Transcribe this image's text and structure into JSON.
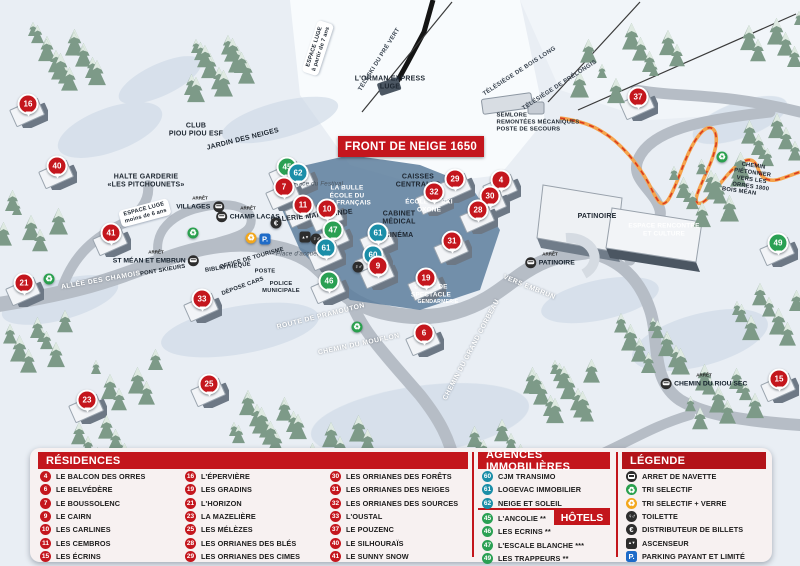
{
  "colors": {
    "red": "#c4161d",
    "teal": "#1b8ea8",
    "green": "#2aa053",
    "panel_red": "#c3161c"
  },
  "map": {
    "banner": "FRONT DE NEIGE 1650",
    "bus_stop_prefix": "ARRÊT",
    "markers": [
      {
        "n": "16",
        "c": "red",
        "x": 28,
        "y": 104
      },
      {
        "n": "40",
        "c": "red",
        "x": 57,
        "y": 166
      },
      {
        "n": "41",
        "c": "red",
        "x": 111,
        "y": 233
      },
      {
        "n": "21",
        "c": "red",
        "x": 24,
        "y": 283
      },
      {
        "n": "33",
        "c": "red",
        "x": 202,
        "y": 299
      },
      {
        "n": "23",
        "c": "red",
        "x": 87,
        "y": 400
      },
      {
        "n": "25",
        "c": "red",
        "x": 209,
        "y": 384
      },
      {
        "n": "45",
        "c": "green",
        "x": 287,
        "y": 167
      },
      {
        "n": "62",
        "c": "teal",
        "x": 298,
        "y": 173
      },
      {
        "n": "7",
        "c": "red",
        "x": 284,
        "y": 187
      },
      {
        "n": "11",
        "c": "red",
        "x": 303,
        "y": 205
      },
      {
        "n": "10",
        "c": "red",
        "x": 327,
        "y": 209
      },
      {
        "n": "47",
        "c": "green",
        "x": 333,
        "y": 230
      },
      {
        "n": "61",
        "c": "teal",
        "x": 326,
        "y": 248
      },
      {
        "n": "61",
        "c": "teal",
        "x": 378,
        "y": 233
      },
      {
        "n": "60",
        "c": "teal",
        "x": 373,
        "y": 255
      },
      {
        "n": "9",
        "c": "red",
        "x": 378,
        "y": 266
      },
      {
        "n": "46",
        "c": "green",
        "x": 329,
        "y": 281
      },
      {
        "n": "19",
        "c": "red",
        "x": 426,
        "y": 278
      },
      {
        "n": "6",
        "c": "red",
        "x": 424,
        "y": 333
      },
      {
        "n": "32",
        "c": "red",
        "x": 434,
        "y": 192
      },
      {
        "n": "29",
        "c": "red",
        "x": 455,
        "y": 179
      },
      {
        "n": "4",
        "c": "red",
        "x": 501,
        "y": 180
      },
      {
        "n": "30",
        "c": "red",
        "x": 490,
        "y": 196
      },
      {
        "n": "28",
        "c": "red",
        "x": 478,
        "y": 210
      },
      {
        "n": "31",
        "c": "red",
        "x": 452,
        "y": 241
      },
      {
        "n": "37",
        "c": "red",
        "x": 638,
        "y": 97
      },
      {
        "n": "49",
        "c": "green",
        "x": 778,
        "y": 243
      },
      {
        "n": "15",
        "c": "red",
        "x": 779,
        "y": 379
      }
    ],
    "labels": [
      {
        "text": "L'ORMAN EXPRESS\nLUGE",
        "x": 390,
        "y": 84,
        "r": 0,
        "cls": "map-bold"
      },
      {
        "text": "TÉLÉSKI DU PRÉ VERT",
        "x": 380,
        "y": 60,
        "r": -58,
        "cls": "map-small"
      },
      {
        "text": "TÉLÉSIÈGE DE BOIS LONG",
        "x": 520,
        "y": 72,
        "r": -33,
        "cls": "map-small"
      },
      {
        "text": "TÉLÉSIÈGE DE PRÉLONGIS",
        "x": 560,
        "y": 86,
        "r": -33,
        "cls": "map-small"
      },
      {
        "text": "SEMLORE\nREMONTÉES MÉCANIQUES\nPOSTE DE SECOURS",
        "x": 538,
        "y": 123,
        "r": 0,
        "cls": "map-bold-left"
      },
      {
        "text": "ESPACE LUGE\nà partir de 7 ans",
        "x": 318,
        "y": 48,
        "r": -72,
        "cls": "map-pill"
      },
      {
        "text": "ESPACE LUGE\nmoins de 6 ans",
        "x": 145,
        "y": 213,
        "r": -15,
        "cls": "map-pill"
      },
      {
        "text": "CLUB\nPIOU PIOU ESF",
        "x": 196,
        "y": 131,
        "r": 0,
        "cls": "map-bold"
      },
      {
        "text": "JARDIN DES NEIGES",
        "x": 243,
        "y": 140,
        "r": -14,
        "cls": "map-bold"
      },
      {
        "text": "HALTE GARDERIE\n«LES PITCHOUNETS»",
        "x": 146,
        "y": 182,
        "r": 0,
        "cls": "map-bold"
      },
      {
        "text": "GALERIE MARCHANDE",
        "x": 312,
        "y": 217,
        "r": -6,
        "cls": "map-bold"
      },
      {
        "text": "LA BULLE\nÉCOLE DU\nSKI FRANÇAIS",
        "x": 347,
        "y": 196,
        "r": 0,
        "cls": "map-white"
      },
      {
        "text": "Place du Festival",
        "x": 318,
        "y": 184,
        "r": 0,
        "cls": "map-italic"
      },
      {
        "text": "Place d'accueil",
        "x": 298,
        "y": 254,
        "r": 0,
        "cls": "map-italic"
      },
      {
        "text": "OFFICE DE TOURISME",
        "x": 252,
        "y": 259,
        "r": -16,
        "cls": "map-tiny"
      },
      {
        "text": "BIBLIOTHÈQUE",
        "x": 228,
        "y": 268,
        "r": -8,
        "cls": "map-tiny"
      },
      {
        "text": "POSTE",
        "x": 265,
        "y": 272,
        "r": 0,
        "cls": "map-tiny"
      },
      {
        "text": "DÉPOSE CARS",
        "x": 243,
        "y": 287,
        "r": -20,
        "cls": "map-tiny"
      },
      {
        "text": "POLICE\nMUNICIPALE",
        "x": 281,
        "y": 288,
        "r": 0,
        "cls": "map-tiny"
      },
      {
        "text": "CAISSES\nCENTRALES",
        "x": 418,
        "y": 182,
        "r": 0,
        "cls": "map-bold"
      },
      {
        "text": "CABINET\nMÉDICAL",
        "x": 399,
        "y": 219,
        "r": 0,
        "cls": "map-bold"
      },
      {
        "text": "CINÉMA",
        "x": 399,
        "y": 236,
        "r": 0,
        "cls": "map-bold"
      },
      {
        "text": "LAVERIE",
        "x": 466,
        "y": 152,
        "r": 0,
        "cls": "map-bold"
      },
      {
        "text": "ÉCOLE DE SKI\nOXONE",
        "x": 429,
        "y": 206,
        "r": 0,
        "cls": "map-white"
      },
      {
        "text": "SALLE DE\nSPECTACLE",
        "x": 431,
        "y": 291,
        "r": 0,
        "cls": "map-white"
      },
      {
        "text": "GENDARMERIE",
        "x": 438,
        "y": 302,
        "r": 0,
        "cls": "map-white-tiny"
      },
      {
        "text": "PATINOIRE",
        "x": 597,
        "y": 217,
        "r": 0,
        "cls": "map-bold"
      },
      {
        "text": "VERS EMBRUN",
        "x": 529,
        "y": 288,
        "r": 22,
        "cls": "map-road"
      },
      {
        "text": "ESPACE RENCONTRE\nET CULTURE",
        "x": 664,
        "y": 230,
        "r": 0,
        "cls": "map-white"
      },
      {
        "text": "CHEMIN PIÉTONNIER\nVERS LES ORRES 1800",
        "x": 752,
        "y": 177,
        "r": 8,
        "cls": "map-tiny"
      },
      {
        "text": "BOIS MÉAN",
        "x": 739,
        "y": 192,
        "r": 8,
        "cls": "map-tiny"
      },
      {
        "text": "ALLÉE DES CHAMOIS",
        "x": 101,
        "y": 281,
        "r": -10,
        "cls": "map-road"
      },
      {
        "text": "PONT SKIEURS",
        "x": 163,
        "y": 271,
        "r": -10,
        "cls": "map-tiny"
      },
      {
        "text": "ROUTE DE PRAMOUTON",
        "x": 321,
        "y": 317,
        "r": -14,
        "cls": "map-road"
      },
      {
        "text": "CHEMIN DU MOUFLON",
        "x": 359,
        "y": 345,
        "r": -12,
        "cls": "map-road"
      },
      {
        "text": "CHEMIN DU GRAND CORBEAU",
        "x": 472,
        "y": 350,
        "r": -62,
        "cls": "map-road"
      }
    ],
    "bus_stops": [
      {
        "label": "VILLAGES",
        "x": 200,
        "y": 204,
        "side": "right"
      },
      {
        "label": "CHAMP LACAS",
        "x": 248,
        "y": 214,
        "side": "left"
      },
      {
        "label": "ST MÉAN ET EMBRUN",
        "x": 156,
        "y": 258,
        "side": "right"
      },
      {
        "label": "PATINOIRE",
        "x": 550,
        "y": 260,
        "side": "left"
      },
      {
        "label": "CHEMIN DU RIOU SEC",
        "x": 704,
        "y": 381,
        "side": "left"
      }
    ],
    "amenities": [
      {
        "type": "recycle-green",
        "x": 193,
        "y": 233
      },
      {
        "type": "recycle-green",
        "x": 49,
        "y": 279
      },
      {
        "type": "recycle-green",
        "x": 357,
        "y": 327
      },
      {
        "type": "recycle-green",
        "x": 722,
        "y": 157
      },
      {
        "type": "recycle-yellow",
        "x": 251,
        "y": 238
      },
      {
        "type": "parking",
        "x": 265,
        "y": 239
      },
      {
        "type": "euro",
        "x": 276,
        "y": 223
      },
      {
        "type": "elevator",
        "x": 305,
        "y": 237
      },
      {
        "type": "toilet",
        "x": 316,
        "y": 239
      },
      {
        "type": "toilet",
        "x": 358,
        "y": 267
      }
    ]
  },
  "panel": {
    "residences": {
      "title": "RÉSIDENCES",
      "columns": [
        [
          {
            "n": "4",
            "label": "LE BALCON DES ORRES"
          },
          {
            "n": "6",
            "label": "LE BELVÉDÈRE"
          },
          {
            "n": "7",
            "label": "LE BOUSSOLENC"
          },
          {
            "n": "9",
            "label": "LE CAIRN"
          },
          {
            "n": "10",
            "label": "LES CARLINES"
          },
          {
            "n": "11",
            "label": "LES CEMBROS"
          },
          {
            "n": "15",
            "label": "LES ÉCRINS"
          }
        ],
        [
          {
            "n": "16",
            "label": "L'ÉPERVIÈRE"
          },
          {
            "n": "19",
            "label": "LES GRADINS"
          },
          {
            "n": "21",
            "label": "L'HORIZON"
          },
          {
            "n": "23",
            "label": "LA MAZELIÈRE"
          },
          {
            "n": "25",
            "label": "LES MÉLÈZES"
          },
          {
            "n": "28",
            "label": "LES ORRIANES DES BLÉS"
          },
          {
            "n": "29",
            "label": "LES ORRIANES DES CIMES"
          }
        ],
        [
          {
            "n": "30",
            "label": "LES ORRIANES DES FORÊTS"
          },
          {
            "n": "31",
            "label": "LES ORRIANES DES NEIGES"
          },
          {
            "n": "32",
            "label": "LES ORRIANES DES SOURCES"
          },
          {
            "n": "33",
            "label": "L'OUSTAL"
          },
          {
            "n": "37",
            "label": "LE POUZENC"
          },
          {
            "n": "40",
            "label": "LE SILHOURAÏS"
          },
          {
            "n": "41",
            "label": "LE SUNNY SNOW"
          }
        ]
      ]
    },
    "agences": {
      "title": "AGENCES IMMOBILIÈRES",
      "items": [
        {
          "n": "60",
          "label": "CJM TRANSIMO"
        },
        {
          "n": "61",
          "label": "LOGEVAC IMMOBILIER"
        },
        {
          "n": "62",
          "label": "NEIGE ET SOLEIL"
        }
      ]
    },
    "hotels": {
      "title": "HÔTELS",
      "items": [
        {
          "n": "45",
          "label": "L'ANCOLIE **"
        },
        {
          "n": "46",
          "label": "LES ECRINS **"
        },
        {
          "n": "47",
          "label": "L'ESCALE BLANCHE ***"
        },
        {
          "n": "49",
          "label": "LES TRAPPEURS **"
        }
      ]
    },
    "legende": {
      "title": "LÉGENDE",
      "items": [
        {
          "icon": "bus",
          "label": "ARRET DE NAVETTE"
        },
        {
          "icon": "recycle-green",
          "label": "TRI SELECTIF"
        },
        {
          "icon": "recycle-yellow",
          "label": "TRI SELECTIF + VERRE"
        },
        {
          "icon": "toilet",
          "label": "TOILETTE"
        },
        {
          "icon": "euro",
          "label": "DISTRIBUTEUR DE BILLETS"
        },
        {
          "icon": "elevator",
          "label": "ASCENSEUR"
        },
        {
          "icon": "parking",
          "label": "PARKING PAYANT ET LIMITÉ"
        }
      ]
    }
  }
}
